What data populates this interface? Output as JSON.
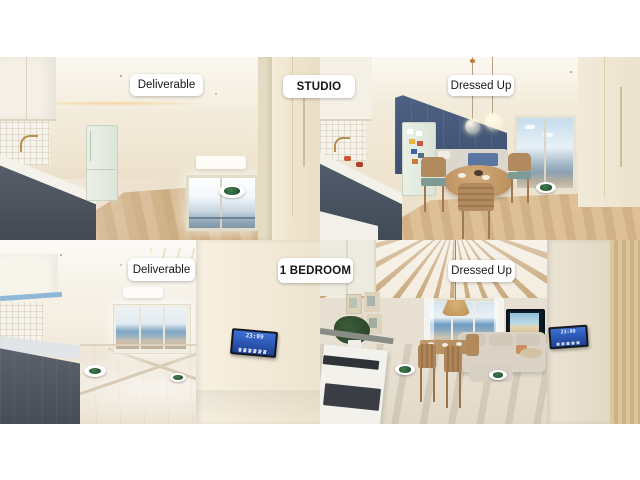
{
  "units": [
    {
      "id": "studio",
      "title": "STUDIO",
      "versions": [
        {
          "id": "deliverable",
          "label": "Deliverable"
        },
        {
          "id": "dressed-up",
          "label": "Dressed Up"
        }
      ]
    },
    {
      "id": "one-bedroom",
      "title": "1 BEDROOM",
      "versions": [
        {
          "id": "deliverable",
          "label": "Deliverable"
        },
        {
          "id": "dressed-up",
          "label": "Dressed Up"
        }
      ]
    }
  ],
  "wall_panel": {
    "time": "23:09"
  },
  "hotspot": {
    "ring_color": "#ffffff",
    "core_color": "#24512f"
  },
  "colors": {
    "background": "#ffffff",
    "accent_wall_blue": "#48597a",
    "cabinet_slate": "#565d68",
    "fridge_mint": "#e4ebe1",
    "wood_floor": "#cfae83",
    "sea_blue": "#7aa3c4",
    "beam_wood": "#c9a87c",
    "hood_strip_blue": "#8fb8d6",
    "panel_screen_blue": "#2f63c8"
  }
}
